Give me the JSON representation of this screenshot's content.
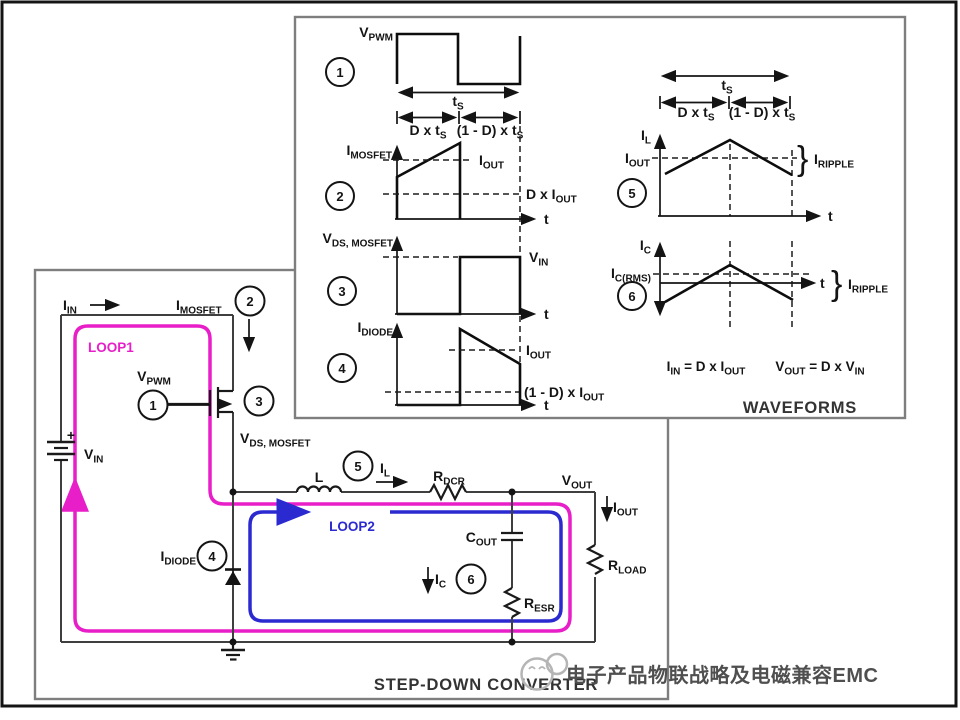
{
  "colors": {
    "loop1": "#e81ec8",
    "loop2": "#2a2ad0",
    "watermark": "#4f4f4f",
    "logo": "#b5b5b5"
  },
  "titles": {
    "waveforms": "WAVEFORMS",
    "converter": "STEP-DOWN CONVERTER"
  },
  "watermark": "电子产品物联战略及电磁兼容EMC",
  "steps": {
    "s1": "1",
    "s2": "2",
    "s3": "3",
    "s4": "4",
    "s5": "5",
    "s6": "6"
  },
  "labels": {
    "vpwm": [
      {
        "t": "V"
      },
      {
        "t": "PWM",
        "s": 1
      }
    ],
    "ts": [
      {
        "t": "t"
      },
      {
        "t": "S",
        "s": 1
      }
    ],
    "d_x_ts": [
      {
        "t": "D x t"
      },
      {
        "t": "S",
        "s": 1
      }
    ],
    "omd_x_ts": [
      {
        "t": "(1 - D) x t"
      },
      {
        "t": "S",
        "s": 1
      }
    ],
    "imosfet": [
      {
        "t": "I"
      },
      {
        "t": "MOSFET",
        "s": 1
      }
    ],
    "iout": [
      {
        "t": "I"
      },
      {
        "t": "OUT",
        "s": 1
      }
    ],
    "d_x_iout": [
      {
        "t": "D x I"
      },
      {
        "t": "OUT",
        "s": 1
      }
    ],
    "vds_mosfet": [
      {
        "t": "V"
      },
      {
        "t": "DS, MOSFET",
        "s": 1
      }
    ],
    "vin": [
      {
        "t": "V"
      },
      {
        "t": "IN",
        "s": 1
      }
    ],
    "idiode": [
      {
        "t": "I"
      },
      {
        "t": "DIODE",
        "s": 1
      }
    ],
    "omd_x_iout": [
      {
        "t": "(1 - D) x I"
      },
      {
        "t": "OUT",
        "s": 1
      }
    ],
    "il": [
      {
        "t": "I"
      },
      {
        "t": "L",
        "s": 1
      }
    ],
    "iripple": [
      {
        "t": "I"
      },
      {
        "t": "RIPPLE",
        "s": 1
      }
    ],
    "ic": [
      {
        "t": "I"
      },
      {
        "t": "C",
        "s": 1
      }
    ],
    "ic_rms": [
      {
        "t": "I"
      },
      {
        "t": "C(RMS)",
        "s": 1
      }
    ],
    "iin": [
      {
        "t": "I"
      },
      {
        "t": "IN",
        "s": 1
      }
    ],
    "t": "t",
    "inductor": "L",
    "rdcr": [
      {
        "t": "R"
      },
      {
        "t": "DCR",
        "s": 1
      }
    ],
    "vout": [
      {
        "t": "V"
      },
      {
        "t": "OUT",
        "s": 1
      }
    ],
    "cout": [
      {
        "t": "C"
      },
      {
        "t": "OUT",
        "s": 1
      }
    ],
    "resr": [
      {
        "t": "R"
      },
      {
        "t": "ESR",
        "s": 1
      }
    ],
    "rload": [
      {
        "t": "R"
      },
      {
        "t": "LOAD",
        "s": 1
      }
    ],
    "loop1": "LOOP1",
    "loop2": "LOOP2",
    "plus": "+",
    "brace": "}"
  },
  "equations": {
    "input": [
      {
        "t": "I"
      },
      {
        "t": "IN",
        "s": 1
      },
      {
        "t": " = D x I"
      },
      {
        "t": "OUT",
        "s": 1
      }
    ],
    "output": [
      {
        "t": "V"
      },
      {
        "t": "OUT",
        "s": 1
      },
      {
        "t": " = D x V"
      },
      {
        "t": "IN",
        "s": 1
      }
    ]
  }
}
